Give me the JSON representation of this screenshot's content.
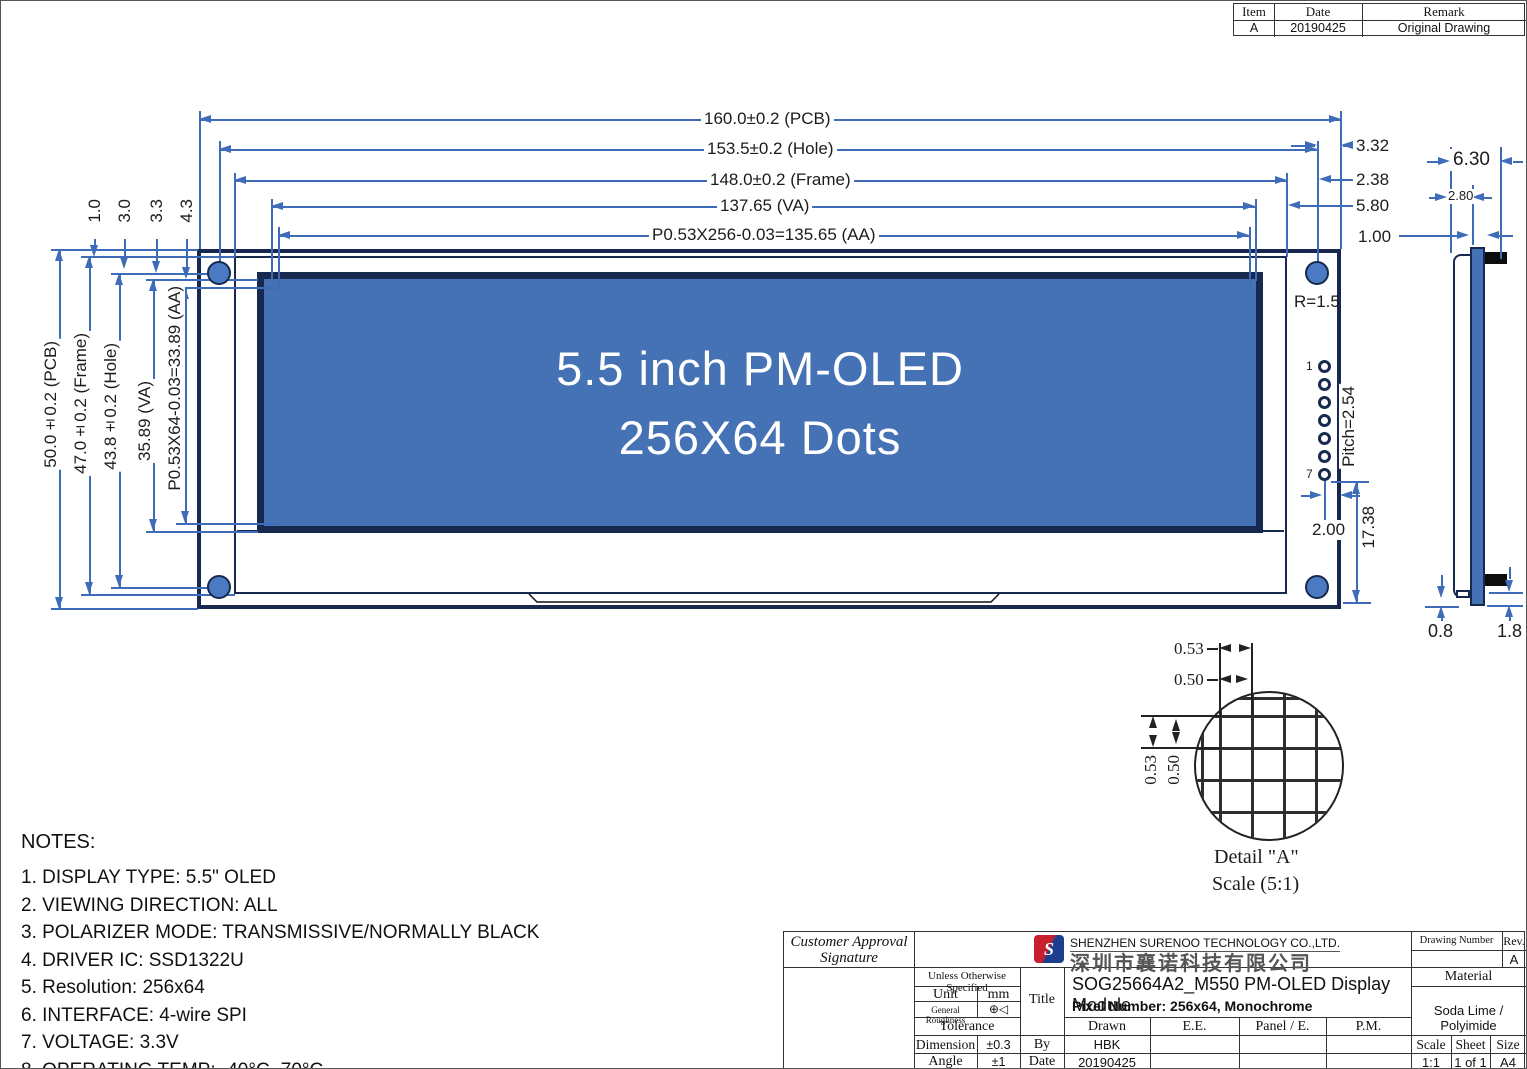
{
  "revision_table": {
    "headers": [
      "Item",
      "Date",
      "Remark"
    ],
    "row": {
      "item": "A",
      "date": "20190425",
      "remark": "Original Drawing"
    }
  },
  "front_view": {
    "screen": {
      "line1": "5.5 inch PM-OLED",
      "line2": "256X64 Dots"
    },
    "dims_top": [
      "160.0±0.2 (PCB)",
      "153.5±0.2 (Hole)",
      "148.0±0.2 (Frame)",
      "137.65 (VA)",
      "P0.53X256-0.03=135.65 (AA)"
    ],
    "dims_left_vertical": [
      "50.0±0.2 (PCB)",
      "47.0±0.2 (Frame)",
      "43.8±0.2 (Hole)",
      "35.89 (VA)",
      "P0.53X64-0.03=33.89 (AA)"
    ],
    "dims_left_small": [
      "1.0",
      "3.0",
      "3.3",
      "4.3"
    ],
    "dims_right_small": [
      "3.32",
      "2.38",
      "5.80",
      "1.00"
    ],
    "hole_radius_label": "R=1.5",
    "pins": {
      "first": "1",
      "last": "7",
      "pitch_label": "Pitch=2.54",
      "offset_label": "2.00",
      "bottom_label": "17.38"
    }
  },
  "side_view": {
    "width_label": "6.30",
    "glass_offset_label": "2.80",
    "bottom_left_label": "0.8",
    "bottom_right_label": "1.8"
  },
  "detail_a": {
    "dims_top": [
      "0.53",
      "0.50"
    ],
    "dims_left": [
      "0.53",
      "0.50"
    ],
    "caption": "Detail \"A\"",
    "scale": "Scale (5:1)"
  },
  "notes": {
    "heading": "NOTES:",
    "items": [
      "1. DISPLAY TYPE: 5.5\" OLED",
      "2. VIEWING DIRECTION: ALL",
      "3. POLARIZER MODE: TRANSMISSIVE/NORMALLY BLACK",
      "4. DRIVER IC: SSD1322U",
      "5. Resolution: 256x64",
      "6. INTERFACE: 4-wire SPI",
      "7. VOLTAGE: 3.3V",
      "8. OPERATING TEMP: -40°C~70°C"
    ]
  },
  "title_block": {
    "customer_line1": "Customer Approval",
    "customer_line2": "Signature",
    "unless": "Unless Otherwise Specified",
    "unit_label": "Unit",
    "unit_value": "mm",
    "roughness_label": "General Roughness",
    "roughness_symbol": "⊕◁",
    "tolerance_label": "Tolerance",
    "dimension_label": "Dimension",
    "dimension_value": "±0.3",
    "angle_label": "Angle",
    "angle_value": "±1",
    "title_label": "Title",
    "by_label": "By",
    "date_label": "Date",
    "company_en": "SHENZHEN SURENOO TECHNOLOGY CO.,LTD.",
    "company_cn": "深圳市襄诺科技有限公司",
    "logo_letter": "S",
    "product_title": "SOG25664A2_M550 PM-OLED Display Module",
    "pixel_number": "Pixel Number: 256x64, Monochrome",
    "drawn_label": "Drawn",
    "ee_label": "E.E.",
    "panel_label": "Panel / E.",
    "pm_label": "P.M.",
    "drawn_value": "HBK",
    "date_value": "20190425",
    "drawing_number_label": "Drawing Number",
    "rev_label": "Rev.",
    "rev_value": "A",
    "material_label": "Material",
    "material_value": "Soda Lime / Polyimide",
    "scale_label": "Scale",
    "sheet_label": "Sheet",
    "size_label": "Size",
    "scale_value": "1:1",
    "sheet_value": "1 of 1",
    "size_value": "A4"
  },
  "colors": {
    "outline": "#17294e",
    "screen_fill": "#4571b5",
    "dim_line": "#3e6cb8",
    "hole_fill": "#4a7ac2"
  }
}
